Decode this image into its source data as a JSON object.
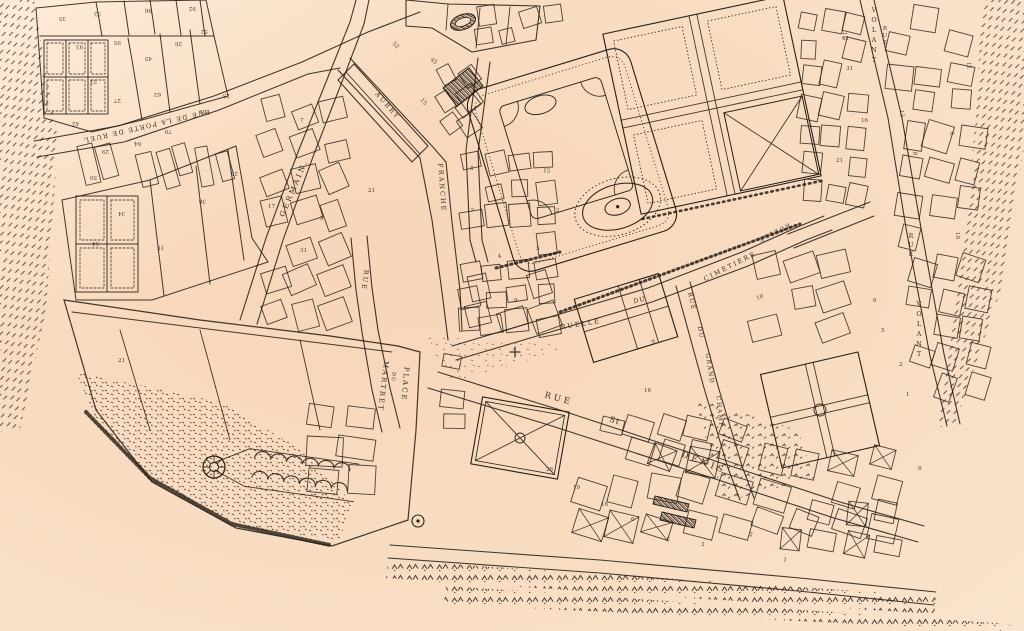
{
  "map": {
    "kind": "scanned engraved historical town plan",
    "paper_color": "#f8dcc2",
    "paper_light": "#fdecd9",
    "ink_color": "#261f16",
    "street_names": [
      "RUE DE LA PORTE DE RUEL",
      "GERMAIN.",
      "RUE",
      "AUBRY",
      "FRANCHE",
      "PLACE DU MARTRET",
      "RUELLE DU CIMETIERE",
      "RUE DU GRAND CHAMP",
      "RUE ST DENIS",
      "RUE VOLANT"
    ],
    "labels": [
      {
        "id": "porte-de-ruel",
        "text": "RUE DE LA PORTE DE RUEL",
        "x": 146,
        "y": 124,
        "rot": 167,
        "size": 6.5,
        "ls": 1.4,
        "flipped": true
      },
      {
        "id": "germain",
        "text": "GERMAIN.",
        "x": 296,
        "y": 189,
        "rot": -67,
        "size": 7.5,
        "ls": 2.5
      },
      {
        "id": "rue-center",
        "text": "RUE",
        "x": 363,
        "y": 280,
        "rot": 97,
        "size": 6.5,
        "ls": 2
      },
      {
        "id": "aubry",
        "text": "AUBRY",
        "x": 386,
        "y": 107,
        "rot": 49,
        "size": 6.5,
        "ls": 2
      },
      {
        "id": "franche",
        "text": "FRANCHE",
        "x": 440,
        "y": 188,
        "rot": 86,
        "size": 6.5,
        "ls": 2
      },
      {
        "id": "place",
        "text": "PLACE",
        "x": 403,
        "y": 384,
        "rot": 95,
        "size": 7,
        "ls": 2
      },
      {
        "id": "place-du",
        "text": "DU",
        "x": 392,
        "y": 377,
        "rot": 95,
        "size": 5,
        "ls": 1
      },
      {
        "id": "martret",
        "text": "MARTRET",
        "x": 381,
        "y": 386,
        "rot": 97,
        "size": 7,
        "ls": 2
      },
      {
        "id": "ruelle",
        "text": "RUELLE",
        "x": 581,
        "y": 326,
        "rot": -9,
        "size": 6.5,
        "ls": 2
      },
      {
        "id": "ruelle-du",
        "text": "DU",
        "x": 640,
        "y": 302,
        "rot": -14,
        "size": 6.5,
        "ls": 1
      },
      {
        "id": "cimetiere",
        "text": "CIMETIERE",
        "x": 731,
        "y": 268,
        "rot": -27,
        "size": 6.5,
        "ls": 2
      },
      {
        "id": "ruelle-flipped",
        "text": "RUELLE",
        "x": 773,
        "y": 231,
        "rot": 153,
        "size": 6,
        "ls": 1.5,
        "flipped": true
      },
      {
        "id": "grand-champ-rue",
        "text": "RUE",
        "x": 690,
        "y": 302,
        "rot": 76,
        "size": 6,
        "ls": 1.5
      },
      {
        "id": "grand-champ-du",
        "text": "DU",
        "x": 699,
        "y": 333,
        "rot": 78,
        "size": 6,
        "ls": 1.5
      },
      {
        "id": "grand-champ-grand",
        "text": "GRAND",
        "x": 708,
        "y": 369,
        "rot": 81,
        "size": 6,
        "ls": 1.5
      },
      {
        "id": "grand-champ-champ",
        "text": "CHAMP",
        "x": 718,
        "y": 412,
        "rot": 84,
        "size": 6,
        "ls": 1.5
      },
      {
        "id": "st-denis-rue",
        "text": "RUE",
        "x": 558,
        "y": 401,
        "rot": 15,
        "size": 8.5,
        "ls": 3
      },
      {
        "id": "st-denis-st",
        "text": "St",
        "x": 614,
        "y": 423,
        "rot": 18,
        "size": 8,
        "ls": 1
      },
      {
        "id": "st-denis-denis",
        "text": "DENIS",
        "x": 703,
        "y": 465,
        "rot": 21,
        "size": 8.5,
        "ls": 3.5
      },
      {
        "id": "volant-top",
        "text": "VOLANT",
        "x": 874,
        "y": 12,
        "stack": true,
        "lh": 10,
        "size": 6.5
      },
      {
        "id": "volant-top-rue",
        "text": "RUE",
        "x": 885,
        "y": 30,
        "stack": true,
        "lh": 7,
        "size": 5.5
      },
      {
        "id": "volant-right-rue",
        "text": "RUE",
        "x": 911,
        "y": 238,
        "stack": true,
        "lh": 9,
        "size": 6
      },
      {
        "id": "volant-right",
        "text": "VOLANT",
        "x": 919,
        "y": 306,
        "stack": true,
        "lh": 10,
        "size": 6.5
      }
    ],
    "parcel_numbers": [
      {
        "n": "35",
        "x": 66,
        "y": 17,
        "r": 180
      },
      {
        "n": "32",
        "x": 101,
        "y": 12,
        "r": 178
      },
      {
        "n": "96",
        "x": 152,
        "y": 9,
        "r": 183
      },
      {
        "n": "92",
        "x": 196,
        "y": 7,
        "r": 180
      },
      {
        "n": "93",
        "x": 83,
        "y": 45,
        "r": 177
      },
      {
        "n": "95",
        "x": 121,
        "y": 41,
        "r": 181
      },
      {
        "n": "45",
        "x": 152,
        "y": 57,
        "r": 180
      },
      {
        "n": "26",
        "x": 182,
        "y": 42,
        "r": 178
      },
      {
        "n": "52",
        "x": 208,
        "y": 30,
        "r": 182
      },
      {
        "n": "57",
        "x": 97,
        "y": 80,
        "r": 179
      },
      {
        "n": "62",
        "x": 161,
        "y": 93,
        "r": 181
      },
      {
        "n": "27",
        "x": 121,
        "y": 99,
        "r": 180
      },
      {
        "n": "42",
        "x": 79,
        "y": 122,
        "r": 177
      },
      {
        "n": "29",
        "x": 109,
        "y": 150,
        "r": 180
      },
      {
        "n": "64",
        "x": 141,
        "y": 142,
        "r": 179
      },
      {
        "n": "79",
        "x": 172,
        "y": 130,
        "r": 182
      },
      {
        "n": "55",
        "x": 206,
        "y": 110,
        "r": 180
      },
      {
        "n": "23",
        "x": 230,
        "y": 94,
        "r": 178
      },
      {
        "n": "50",
        "x": 97,
        "y": 176,
        "r": 180
      },
      {
        "n": "34",
        "x": 125,
        "y": 212,
        "r": 180
      },
      {
        "n": "54",
        "x": 99,
        "y": 242,
        "r": 178
      },
      {
        "n": "31",
        "x": 157,
        "y": 250,
        "r": 0
      },
      {
        "n": "36",
        "x": 206,
        "y": 200,
        "r": 185
      },
      {
        "n": "25",
        "x": 238,
        "y": 172,
        "r": 182
      },
      {
        "n": "17",
        "x": 268,
        "y": 208,
        "r": 0
      },
      {
        "n": "21",
        "x": 368,
        "y": 192,
        "r": 0
      },
      {
        "n": "7",
        "x": 300,
        "y": 122,
        "r": 0
      },
      {
        "n": "9",
        "x": 320,
        "y": 220,
        "r": 0
      },
      {
        "n": "15",
        "x": 420,
        "y": 100,
        "r": 50
      },
      {
        "n": "5",
        "x": 470,
        "y": 170,
        "r": 0
      },
      {
        "n": "4",
        "x": 498,
        "y": 258,
        "r": -10
      },
      {
        "n": "7",
        "x": 470,
        "y": 212,
        "r": 10
      },
      {
        "n": "9",
        "x": 514,
        "y": 302,
        "r": 0
      },
      {
        "n": "3",
        "x": 536,
        "y": 250,
        "r": 0
      },
      {
        "n": "2",
        "x": 556,
        "y": 212,
        "r": 0
      },
      {
        "n": "15",
        "x": 543,
        "y": 172,
        "r": 6
      },
      {
        "n": "16",
        "x": 644,
        "y": 392,
        "r": 0
      },
      {
        "n": "9",
        "x": 652,
        "y": 344,
        "r": -15
      },
      {
        "n": "10",
        "x": 757,
        "y": 300,
        "r": -20
      },
      {
        "n": "11",
        "x": 843,
        "y": 32,
        "r": 88
      },
      {
        "n": "13",
        "x": 900,
        "y": 110,
        "r": 86
      },
      {
        "n": "15",
        "x": 849,
        "y": 36,
        "r": 180
      },
      {
        "n": "16",
        "x": 861,
        "y": 122,
        "r": 0
      },
      {
        "n": "21",
        "x": 836,
        "y": 162,
        "r": 0
      },
      {
        "n": "31",
        "x": 846,
        "y": 70,
        "r": 0
      },
      {
        "n": "10",
        "x": 956,
        "y": 232,
        "r": 90
      },
      {
        "n": "12",
        "x": 967,
        "y": 62,
        "r": 85
      },
      {
        "n": "6",
        "x": 950,
        "y": 132,
        "r": 86
      },
      {
        "n": "8",
        "x": 913,
        "y": 152,
        "r": 84
      },
      {
        "n": "2",
        "x": 899,
        "y": 366,
        "r": 0
      },
      {
        "n": "5",
        "x": 881,
        "y": 332,
        "r": 0
      },
      {
        "n": "6",
        "x": 873,
        "y": 302,
        "r": 0
      },
      {
        "n": "1",
        "x": 906,
        "y": 396,
        "r": 0
      },
      {
        "n": "3",
        "x": 701,
        "y": 546,
        "r": 0
      },
      {
        "n": "5",
        "x": 666,
        "y": 541,
        "r": 10
      },
      {
        "n": "6",
        "x": 631,
        "y": 521,
        "r": 0
      },
      {
        "n": "16",
        "x": 601,
        "y": 506,
        "r": 0
      },
      {
        "n": "19",
        "x": 573,
        "y": 489,
        "r": 0
      },
      {
        "n": "26",
        "x": 546,
        "y": 471,
        "r": 0
      },
      {
        "n": "1",
        "x": 783,
        "y": 561,
        "r": 10
      },
      {
        "n": "2",
        "x": 749,
        "y": 536,
        "r": 8
      },
      {
        "n": "21",
        "x": 118,
        "y": 362,
        "r": 0
      },
      {
        "n": "31",
        "x": 300,
        "y": 252,
        "r": 0
      },
      {
        "n": "6",
        "x": 918,
        "y": 470,
        "r": 0
      },
      {
        "n": "45",
        "x": 430,
        "y": 60,
        "r": 40
      },
      {
        "n": "52",
        "x": 392,
        "y": 44,
        "r": 42
      }
    ]
  }
}
